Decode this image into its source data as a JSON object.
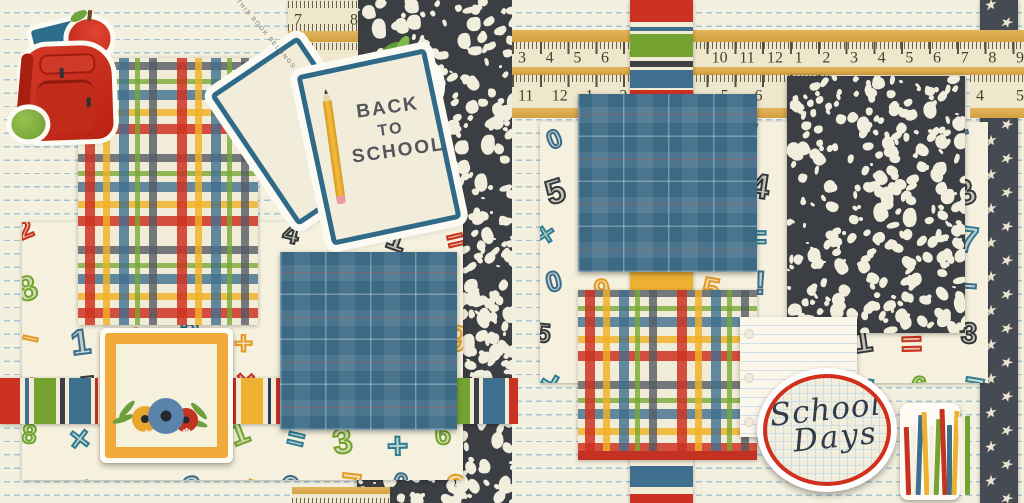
{
  "artwork": {
    "title": "Back To School scrapbook double-page kit",
    "book_sticker": {
      "belongs_text": "THIS BOOK BELONGS TO",
      "line1": "BACK",
      "line2": "TO",
      "line3": "SCHOOL"
    },
    "oval_label": {
      "word1": "School",
      "word2": "Days"
    },
    "rulers": {
      "left_top": [
        "7",
        "8"
      ],
      "right_top": [
        "3",
        "4",
        "5",
        "6",
        "7",
        "8",
        "9",
        "10",
        "11",
        "12",
        "1",
        "2",
        "3",
        "4",
        "5",
        "6",
        "7",
        "8",
        "9"
      ],
      "right_mid": [
        "11",
        "12",
        "1",
        "2",
        "3",
        "4",
        "5",
        "6",
        "7",
        "8"
      ],
      "right_end": [
        "4",
        "5"
      ]
    },
    "pattern_glyphs": [
      "2",
      "0",
      "6",
      "3",
      "1",
      "4",
      "8",
      "5",
      "9",
      "7",
      "+",
      "=",
      "−",
      "×",
      "!"
    ],
    "pattern_palette": [
      "#c7331f",
      "#3a6d8c",
      "#6fa32e",
      "#33383d",
      "#e39b25",
      "#2e7d94"
    ],
    "star_glyph": "★",
    "accent_flower_glyph": "✽",
    "book_spines": [
      "#c7331f",
      "#f4f0e2",
      "#3f6f8e",
      "#eeb031",
      "#f4f0e2",
      "#74a331",
      "#c7331f",
      "#3f6f8e",
      "#eeb031",
      "#f4f0e2",
      "#74a331"
    ],
    "colors": {
      "background_cream": "#f4f0df",
      "line_blue": "#a4c3d4",
      "red": "#c7331f",
      "blue": "#3f6f8e",
      "green": "#74a331",
      "yellow": "#eeb031",
      "charcoal": "#3b3e43",
      "denim": "#3c6984",
      "ruler_wood": "#d2a040",
      "paper_cream": "#f1ecd8",
      "ring_red": "#d2301c"
    }
  }
}
